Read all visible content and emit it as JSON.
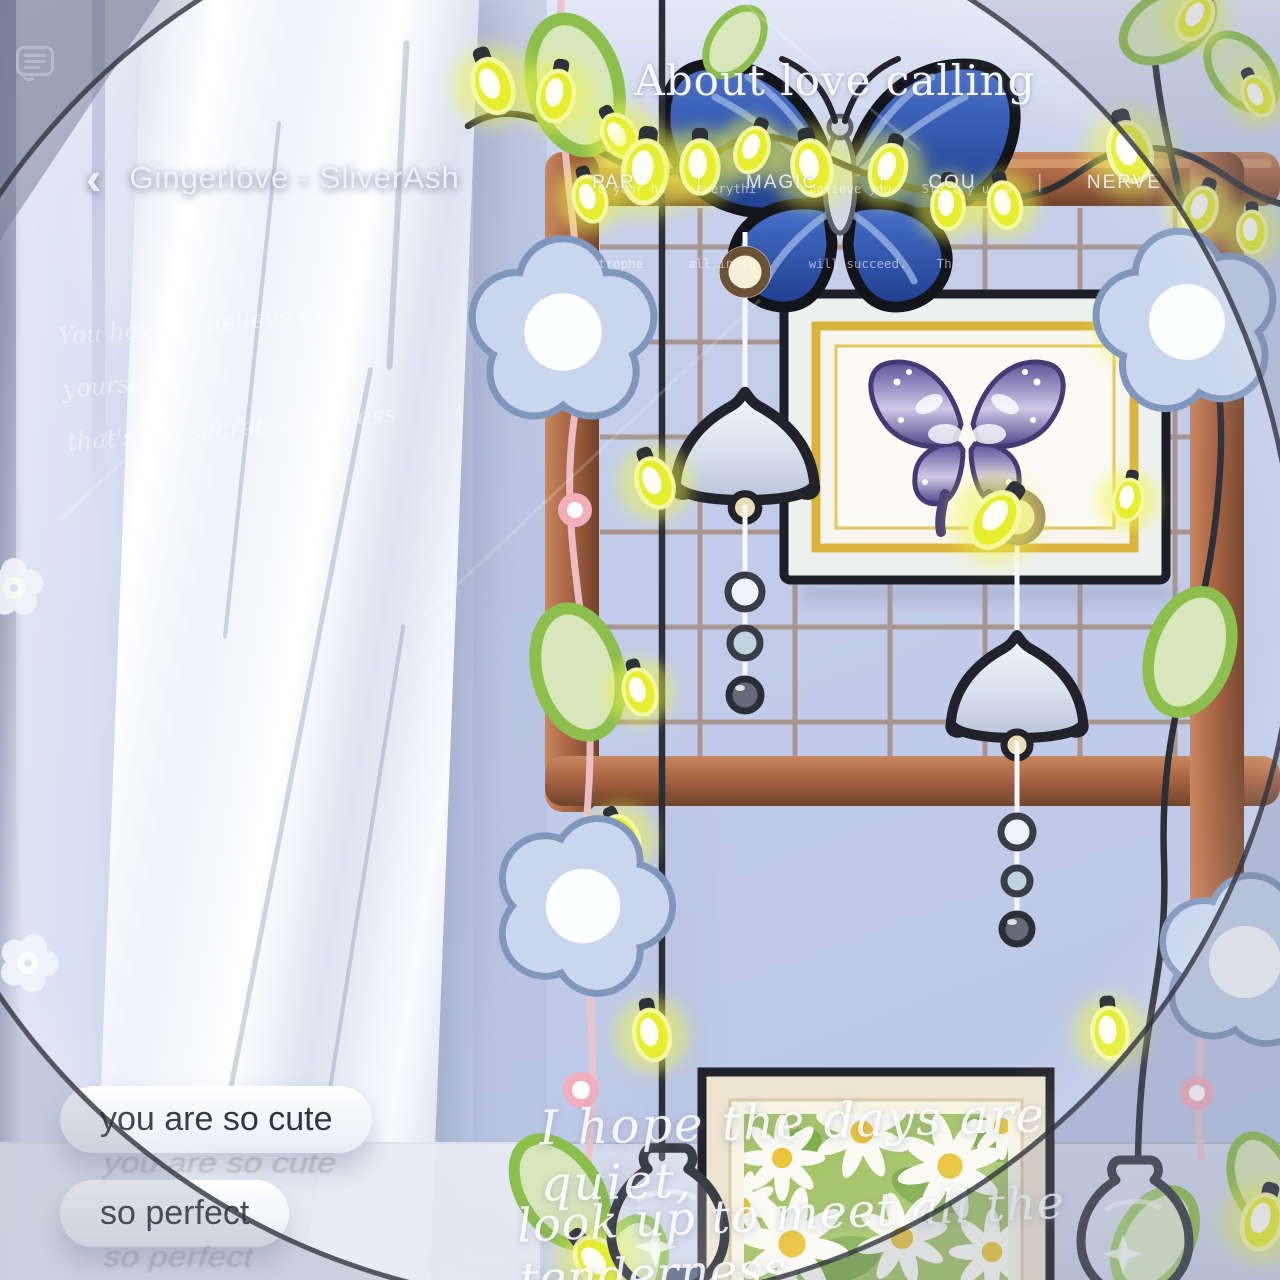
{
  "colors": {
    "wall": "#c3cdea",
    "wood": "#a96443",
    "light_yellow": "#e6ee2f",
    "flower_blue": "#c9d6ee",
    "outline_dark": "#22222a",
    "bubble_text": "#34363f",
    "pink_string": "#edc2ca"
  },
  "statusbar": {
    "chat_icon": "speech-bubble"
  },
  "header": {
    "back_icon": "‹",
    "title": "Gingerlove - SliverAsh"
  },
  "poster": {
    "title": "About love calling",
    "subtitle_line1": "e year ha    everythi       believe you    Sta t y ur w",
    "subtitle_line2": "trophe      all in th       will succeed.    Th",
    "separator": "|",
    "tabs": [
      {
        "label": "PAR"
      },
      {
        "label": "MAGIC"
      },
      {
        "label": "COU"
      },
      {
        "label": "NERVE"
      }
    ]
  },
  "wall_quote": {
    "line1": "You have to believe in yourself",
    "line2": "that's the secret of success"
  },
  "bottom_quote": {
    "line1": "I hope the days are quiet,",
    "line2": "look up to meet all the tenderness."
  },
  "messages": [
    {
      "text": "you are so cute"
    },
    {
      "text": "so perfect"
    }
  ]
}
